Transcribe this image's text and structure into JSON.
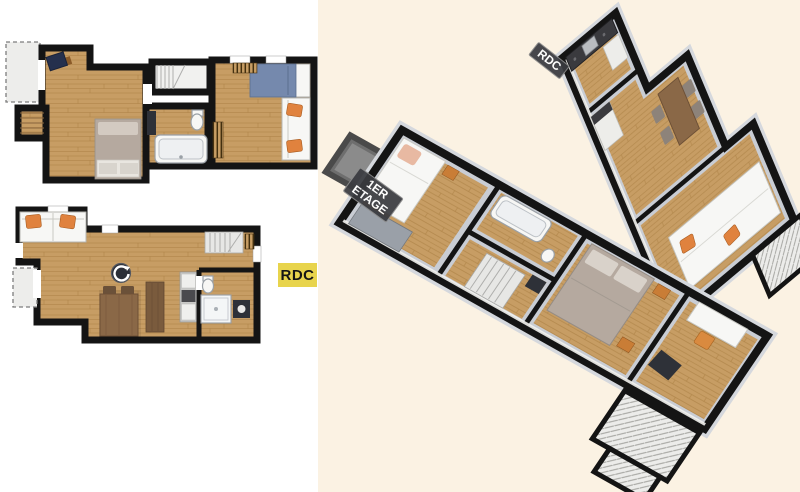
{
  "labels": {
    "ground_floor_2d": "RDC",
    "ground_floor_3d": "RDC",
    "first_floor_3d": "1ER\nETAGE"
  },
  "icons": {
    "rotate_360_icon": "circular-arrow marker on ground-floor 2D plan"
  },
  "colors": {
    "background_left": "#ffffff",
    "background_right": "#fbf2e3",
    "wall": "#141414",
    "wood_floor": "#c79d64",
    "wood_line": "#ac8145",
    "label_yellow": "#e8d44c",
    "label_dark": "#3a3b40",
    "sofa_cushion_orange": "#e0823e",
    "bed_blue": "#7589ad",
    "bed_gray": "#b5a99f",
    "table_brown": "#8a6847",
    "floor_gray_3d": "#c9cdd4",
    "bevel_gray_3d": "#d5d8dd",
    "fixture_white": "#f7f7f5",
    "balcony_gray": "#ededeb",
    "dark_furniture": "#2e3138"
  }
}
